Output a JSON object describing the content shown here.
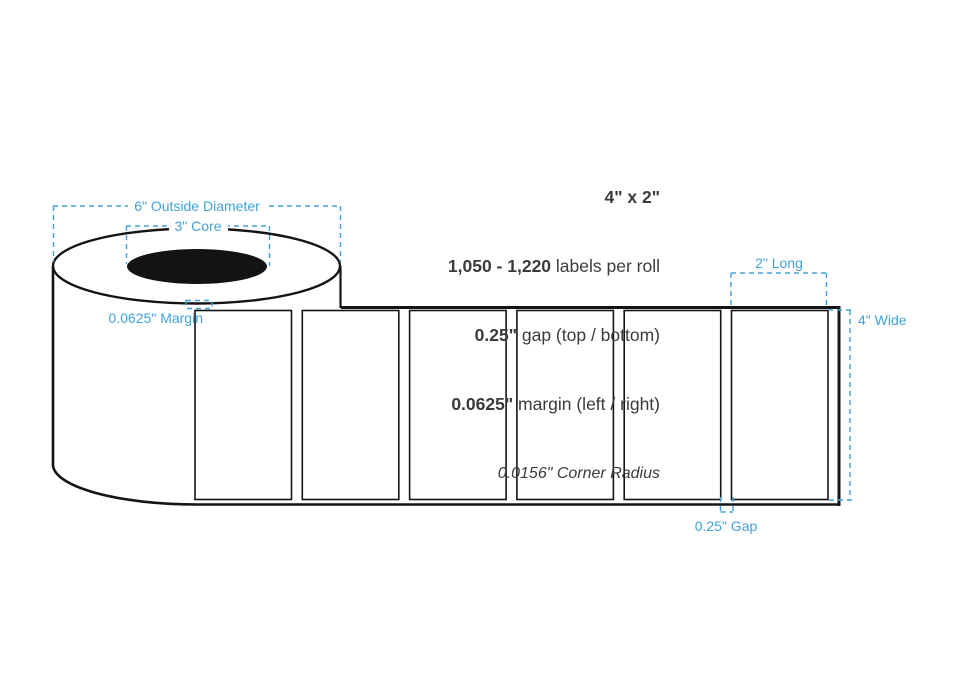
{
  "spec": {
    "size": "4\" x 2\"",
    "labels_value": "1,050 - 1,220",
    "labels_suffix": " labels per roll",
    "gap_value": "0.25\"",
    "gap_suffix": " gap (top / bottom)",
    "margin_value": "0.0625\"",
    "margin_suffix": " margin (left / right)",
    "corner_radius": "0.0156\" Corner Radius"
  },
  "annotations": {
    "outside_diameter": "6\" Outside Diameter",
    "core": "3\" Core",
    "margin": "0.0625\" Margin",
    "long": "2\" Long",
    "wide": "4\" Wide",
    "gap": "0.25\" Gap"
  },
  "diagram": {
    "label_count": 6
  },
  "colors": {
    "annotation": "#41a3db",
    "text": "#3b3b3b",
    "outline": "#141414"
  }
}
